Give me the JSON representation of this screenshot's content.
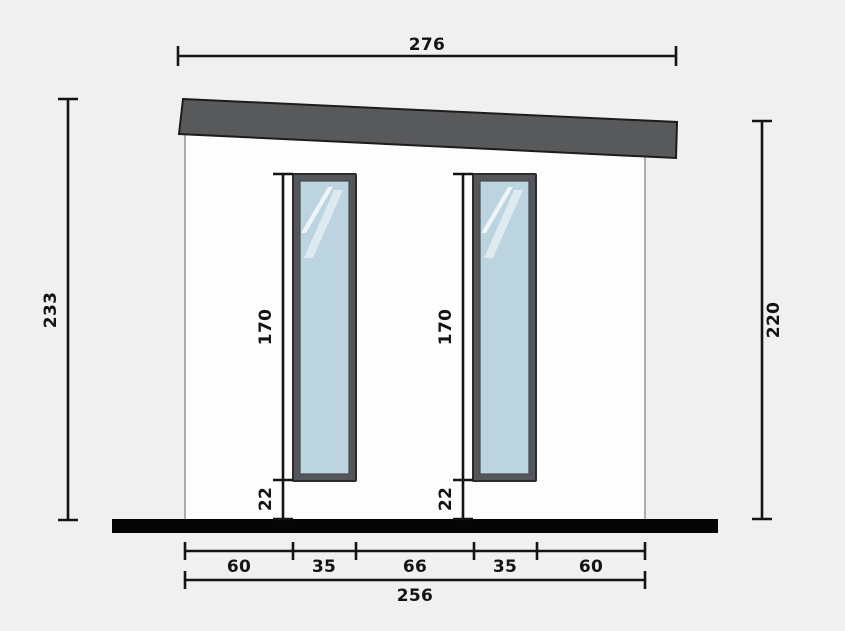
{
  "drawing": {
    "type": "building-elevation-technical-drawing",
    "dimensions": {
      "roof_width": "276",
      "left_overall_height": "233",
      "right_wall_height": "220",
      "windows": [
        {
          "glass_height": "170",
          "sill_height": "22"
        },
        {
          "glass_height": "170",
          "sill_height": "22"
        }
      ],
      "bottom_segments": [
        "60",
        "35",
        "66",
        "35",
        "60"
      ],
      "base_width": "256"
    },
    "colors": {
      "background": "#f0f0f1",
      "roof": "#58595b",
      "wall": "#fdfdfd",
      "floor": "#050505",
      "window_frame": "#54565a",
      "glass": "#bcd4e0",
      "reflection": "#ffffff",
      "dimension": "#141414"
    }
  }
}
